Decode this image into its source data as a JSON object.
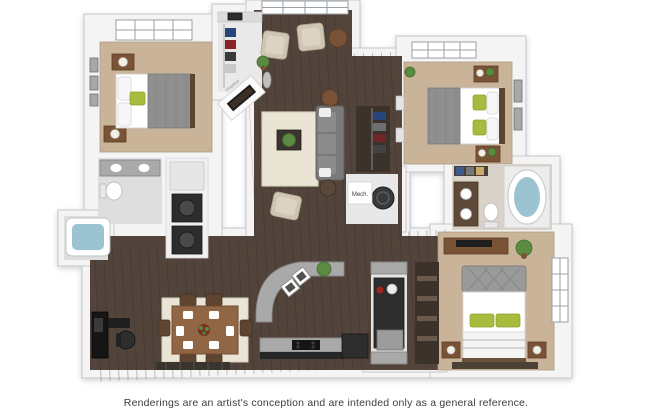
{
  "image": {
    "kind": "3d-floor-plan-rendering",
    "background": "#ffffff",
    "unit_style": "three-bedroom apartment, isometric dollhouse view"
  },
  "caption": {
    "text": "Renderings are an artist's conception and are intended only as a general reference."
  },
  "labels": {
    "mech_room": "Mech.",
    "fireplace": "Fireplace"
  },
  "colors": {
    "wall": "#f4f4f4",
    "wall_edge": "#c7c7c7",
    "wood_floor": "#52443b",
    "carpet": "#c9b499",
    "tile": "#dedede",
    "bath2_tile": "#d8d2c9",
    "closet_floor": "#3a322b",
    "granite": "#a9a9a9",
    "rug_cream": "#eae4d5",
    "rug_dark": "#4a4237",
    "sofa_gray": "#7a7a7a",
    "armchair_beige": "#d0c5b3",
    "accent_green": "#a6bc3c",
    "plant_green": "#5b8a41",
    "wood_furniture": "#7a5336",
    "dining_wood": "#916645",
    "appliance_dark": "#2d2d2d",
    "tub_water": "#9cc3d2",
    "caption_text": "#3b3b3b"
  },
  "rooms": [
    {
      "name": "master-bedroom"
    },
    {
      "name": "master-bathroom"
    },
    {
      "name": "bathtub-nook"
    },
    {
      "name": "laundry-closet"
    },
    {
      "name": "entry-closet"
    },
    {
      "name": "living-room"
    },
    {
      "name": "hall-closet"
    },
    {
      "name": "mechanical-closet"
    },
    {
      "name": "bedroom-2"
    },
    {
      "name": "bathroom-2"
    },
    {
      "name": "bedroom-3"
    },
    {
      "name": "bedroom-3-closet"
    },
    {
      "name": "utility-pantry"
    },
    {
      "name": "kitchen"
    },
    {
      "name": "dining-area"
    },
    {
      "name": "office-nook"
    }
  ]
}
